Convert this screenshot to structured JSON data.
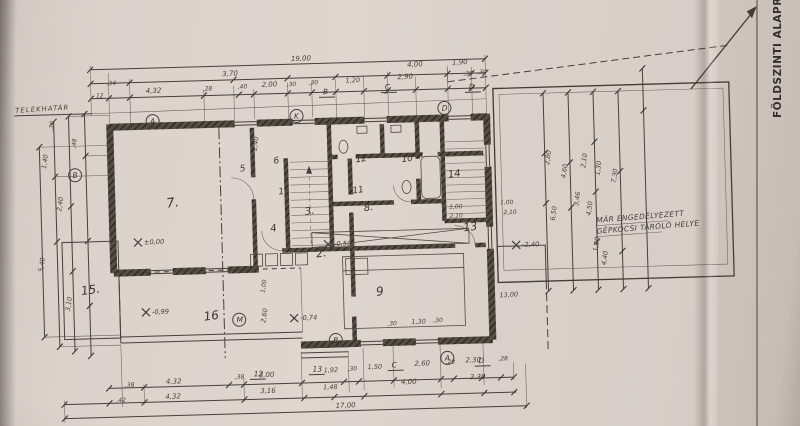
{
  "document": {
    "title_vertical": "FÖLDSZINTI ALAPRAJZ",
    "boundary_label": "TELEKHATÁR",
    "note_line1": "MÁR ENGEDÉLYEZETT",
    "note_line2": "GÉPKOCSI TÁROLÓ HELYE",
    "overall_dim_top": "19,00",
    "overall_dim_bottom": "17,00"
  },
  "colors": {
    "paper": "#d9d1ca",
    "ink": "#3e3831",
    "pencil": "#4a443c",
    "wall_poche": "#544d44"
  },
  "plan": {
    "rooms": [
      {
        "n": "7.",
        "x": 168,
        "y": 204,
        "s": 13
      },
      {
        "n": "15.",
        "x": 80,
        "y": 289,
        "s": 12
      },
      {
        "n": "16",
        "x": 202,
        "y": 318,
        "s": 12
      },
      {
        "n": "5",
        "x": 242,
        "y": 170,
        "s": 9
      },
      {
        "n": "6",
        "x": 276,
        "y": 163,
        "s": 9
      },
      {
        "n": "1",
        "x": 280,
        "y": 194,
        "s": 9
      },
      {
        "n": "3.",
        "x": 306,
        "y": 215,
        "s": 10
      },
      {
        "n": "4",
        "x": 271,
        "y": 231,
        "s": 10
      },
      {
        "n": "2.",
        "x": 316,
        "y": 258,
        "s": 11
      },
      {
        "n": "12",
        "x": 358,
        "y": 164,
        "s": 9
      },
      {
        "n": "10",
        "x": 404,
        "y": 165,
        "s": 9
      },
      {
        "n": "11",
        "x": 354,
        "y": 195,
        "s": 9
      },
      {
        "n": "8.",
        "x": 365,
        "y": 213,
        "s": 10
      },
      {
        "n": "14",
        "x": 450,
        "y": 182,
        "s": 10
      },
      {
        "n": "13",
        "x": 464,
        "y": 236,
        "s": 11
      },
      {
        "n": "9",
        "x": 375,
        "y": 298,
        "s": 12
      }
    ],
    "dims": [
      {
        "t": "19,00",
        "x": 296,
        "y": 61,
        "r": -1,
        "s": 7
      },
      {
        "t": ",34",
        "x": 111,
        "y": 80,
        "r": 0,
        "s": 6
      },
      {
        "t": "3,70",
        "x": 227,
        "y": 74,
        "r": -1,
        "s": 7
      },
      {
        "t": "4,00",
        "x": 412,
        "y": 70,
        "r": -1,
        "s": 7
      },
      {
        "t": "1,90",
        "x": 457,
        "y": 69,
        "r": -1,
        "s": 7
      },
      {
        "t": "12",
        "x": 100,
        "y": 92,
        "r": 0,
        "s": 6
      },
      {
        "t": "4,32",
        "x": 150,
        "y": 89,
        "r": -1,
        "s": 7
      },
      {
        "t": ",28",
        "x": 207,
        "y": 88,
        "r": 0,
        "s": 6
      },
      {
        "t": ",40",
        "x": 242,
        "y": 87,
        "r": 0,
        "s": 6
      },
      {
        "t": "2,00",
        "x": 266,
        "y": 86,
        "r": -1,
        "s": 7
      },
      {
        "t": ",30",
        "x": 291,
        "y": 86,
        "r": 0,
        "s": 6
      },
      {
        "t": ",30",
        "x": 313,
        "y": 85,
        "r": 0,
        "s": 6
      },
      {
        "t": "1,20",
        "x": 350,
        "y": 84,
        "r": -1,
        "s": 6.5
      },
      {
        "t": "2,90",
        "x": 402,
        "y": 82,
        "r": -1,
        "s": 7
      },
      {
        "t": ",30",
        "x": 468,
        "y": 80,
        "r": 0,
        "s": 6
      },
      {
        "t": ",30",
        "x": 482,
        "y": 79,
        "r": 0,
        "s": 6
      },
      {
        "t": ",38",
        "x": 121,
        "y": 382,
        "r": 0,
        "s": 6
      },
      {
        "t": "4,32",
        "x": 162,
        "y": 380,
        "r": 0,
        "s": 7
      },
      {
        "t": ",38",
        "x": 231,
        "y": 377,
        "r": 0,
        "s": 6
      },
      {
        "t": "3,00",
        "x": 255,
        "y": 376,
        "r": 0,
        "s": 7
      },
      {
        "t": "1,92",
        "x": 320,
        "y": 373,
        "r": 0,
        "s": 6.5
      },
      {
        "t": ",30",
        "x": 344,
        "y": 372,
        "r": 0,
        "s": 6
      },
      {
        "t": "1,50",
        "x": 364,
        "y": 371,
        "r": 0,
        "s": 6.5
      },
      {
        "t": "2,60",
        "x": 411,
        "y": 369,
        "r": 0,
        "s": 7
      },
      {
        "t": ",28",
        "x": 442,
        "y": 368,
        "r": 0,
        "s": 6
      },
      {
        "t": "2,30",
        "x": 462,
        "y": 367,
        "r": 0,
        "s": 7
      },
      {
        "t": ",28",
        "x": 495,
        "y": 366,
        "r": 0,
        "s": 6
      },
      {
        "t": ",42",
        "x": 112,
        "y": 397,
        "r": 0,
        "s": 6
      },
      {
        "t": "4,32",
        "x": 161,
        "y": 395,
        "r": 0,
        "s": 7
      },
      {
        "t": "3,16",
        "x": 256,
        "y": 392,
        "r": 0,
        "s": 7
      },
      {
        "t": "1,48",
        "x": 319,
        "y": 390,
        "r": 0,
        "s": 6.5
      },
      {
        "t": "4,00",
        "x": 397,
        "y": 387,
        "r": 0,
        "s": 7
      },
      {
        "t": "2,30",
        "x": 466,
        "y": 384,
        "r": 0,
        "s": 7
      },
      {
        "t": "17,00",
        "x": 331,
        "y": 409,
        "r": -1,
        "s": 7
      },
      {
        "t": ",30",
        "x": 56,
        "y": 124,
        "r": -80,
        "s": 6
      },
      {
        "t": ",48",
        "x": 78,
        "y": 142,
        "r": -80,
        "s": 6
      },
      {
        "t": "1,40",
        "x": 48,
        "y": 162,
        "r": -80,
        "s": 6.5
      },
      {
        "t": "2,40",
        "x": 62,
        "y": 205,
        "r": -80,
        "s": 6.5
      },
      {
        "t": "5,40",
        "x": 42,
        "y": 265,
        "r": -80,
        "s": 6.5
      },
      {
        "t": "3,10",
        "x": 68,
        "y": 305,
        "r": -80,
        "s": 6.5
      },
      {
        "t": "2,40",
        "x": 259,
        "y": 150,
        "r": -80,
        "s": 6.5
      },
      {
        "t": "1,00",
        "x": 263,
        "y": 292,
        "r": -80,
        "s": 6
      },
      {
        "t": "2,60",
        "x": 263,
        "y": 322,
        "r": -80,
        "s": 6.5
      },
      {
        "t": ",30",
        "x": 385,
        "y": 328,
        "r": 0,
        "s": 6
      },
      {
        "t": "1,30",
        "x": 409,
        "y": 327,
        "r": 0,
        "s": 6.5
      },
      {
        "t": ",30",
        "x": 431,
        "y": 326,
        "r": 0,
        "s": 6
      },
      {
        "t": "1,00",
        "x": 450,
        "y": 213,
        "r": 0,
        "s": 6
      },
      {
        "t": "2,10",
        "x": 450,
        "y": 222,
        "r": 0,
        "s": 6
      },
      {
        "t": "1,00",
        "x": 501,
        "y": 210,
        "r": 0,
        "s": 6
      },
      {
        "t": "2,10",
        "x": 504,
        "y": 220,
        "r": 0,
        "s": 6
      },
      {
        "t": "2,80",
        "x": 551,
        "y": 172,
        "r": -80,
        "s": 6.5
      },
      {
        "t": "4,60",
        "x": 567,
        "y": 186,
        "r": -80,
        "s": 6.5
      },
      {
        "t": "2,10",
        "x": 587,
        "y": 176,
        "r": -80,
        "s": 6.5
      },
      {
        "t": "1,30",
        "x": 601,
        "y": 184,
        "r": -80,
        "s": 6.5
      },
      {
        "t": "7,30",
        "x": 617,
        "y": 192,
        "r": -80,
        "s": 6.5
      },
      {
        "t": "6,50",
        "x": 555,
        "y": 228,
        "r": -80,
        "s": 6.5
      },
      {
        "t": "3,46",
        "x": 579,
        "y": 214,
        "r": -80,
        "s": 6.5
      },
      {
        "t": "4,50",
        "x": 591,
        "y": 224,
        "r": -80,
        "s": 6.5
      },
      {
        "t": "1,80",
        "x": 597,
        "y": 260,
        "r": -80,
        "s": 6.5
      },
      {
        "t": "4,40",
        "x": 605,
        "y": 274,
        "r": -80,
        "s": 6.5
      },
      {
        "t": "13,00",
        "x": 498,
        "y": 303,
        "r": -2,
        "s": 6.5
      }
    ],
    "bubbles": [
      {
        "t": "A",
        "x": 156,
        "y": 117,
        "k": "c"
      },
      {
        "t": "K",
        "x": 300,
        "y": 116,
        "k": "c"
      },
      {
        "t": "D",
        "x": 448,
        "y": 112,
        "k": "c"
      },
      {
        "t": "B",
        "x": 77,
        "y": 169,
        "k": "c"
      },
      {
        "t": "M",
        "x": 237,
        "y": 318,
        "k": "c"
      },
      {
        "t": "B",
        "x": 333,
        "y": 341,
        "k": "c"
      },
      {
        "t": "A",
        "x": 444,
        "y": 362,
        "k": "c"
      },
      {
        "t": "B",
        "x": 330,
        "y": 95,
        "k": "p"
      },
      {
        "t": "C",
        "x": 392,
        "y": 92,
        "k": "p"
      },
      {
        "t": "D",
        "x": 476,
        "y": 94,
        "k": "p"
      },
      {
        "t": "12",
        "x": 253,
        "y": 375,
        "k": "p"
      },
      {
        "t": "13",
        "x": 312,
        "y": 372,
        "k": "p"
      },
      {
        "t": "C",
        "x": 391,
        "y": 370,
        "k": "p"
      },
      {
        "t": "D",
        "x": 478,
        "y": 368,
        "k": "p"
      }
    ],
    "elevations": [
      {
        "t": "±0,00",
        "x": 146,
        "y": 240
      },
      {
        "t": "-0,99",
        "x": 152,
        "y": 310
      },
      {
        "t": "-0,52",
        "x": 336,
        "y": 247
      },
      {
        "t": "-0,74",
        "x": 300,
        "y": 320
      },
      {
        "t": "-2,40",
        "x": 524,
        "y": 253
      }
    ]
  }
}
